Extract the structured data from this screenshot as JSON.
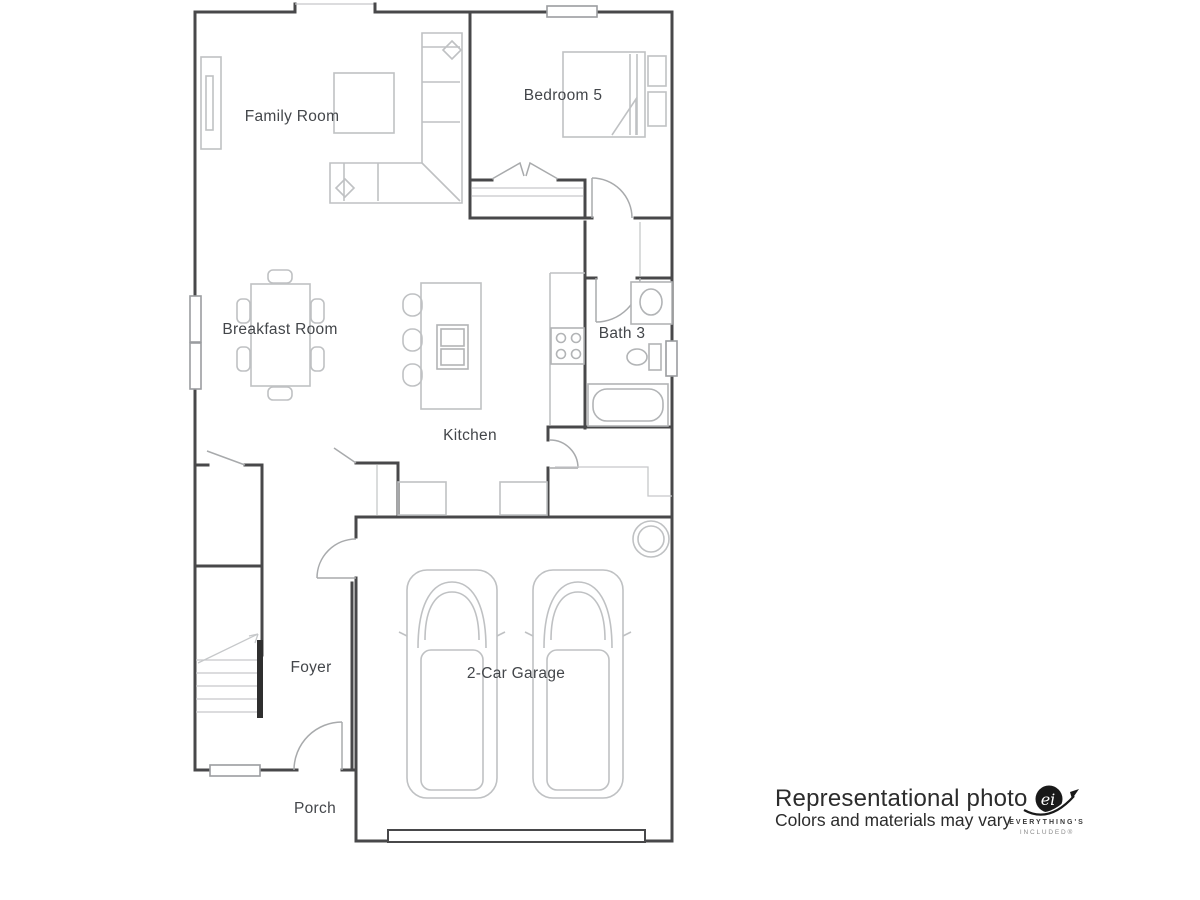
{
  "floor_plan": {
    "rooms": [
      {
        "label": "Family Room"
      },
      {
        "label": "Bedroom 5"
      },
      {
        "label": "Breakfast Room"
      },
      {
        "label": "Bath 3"
      },
      {
        "label": "Kitchen"
      },
      {
        "label": "Foyer"
      },
      {
        "label": "2-Car Garage"
      },
      {
        "label": "Porch"
      }
    ]
  },
  "caption": {
    "line1": "Representational photo",
    "line2": "Colors and materials may vary"
  },
  "brand": {
    "monogram": "ei",
    "line1": "EVERYTHING'S",
    "line2": "INCLUDED®"
  },
  "colors": {
    "wall": "#48484a",
    "furniture": "#bfc1c3",
    "door": "#a8aaac",
    "label": "#43464a",
    "caption": "#2c2c2c",
    "brand_dark": "#191919",
    "brand_gray": "#8b8b8b",
    "background": "#ffffff"
  }
}
